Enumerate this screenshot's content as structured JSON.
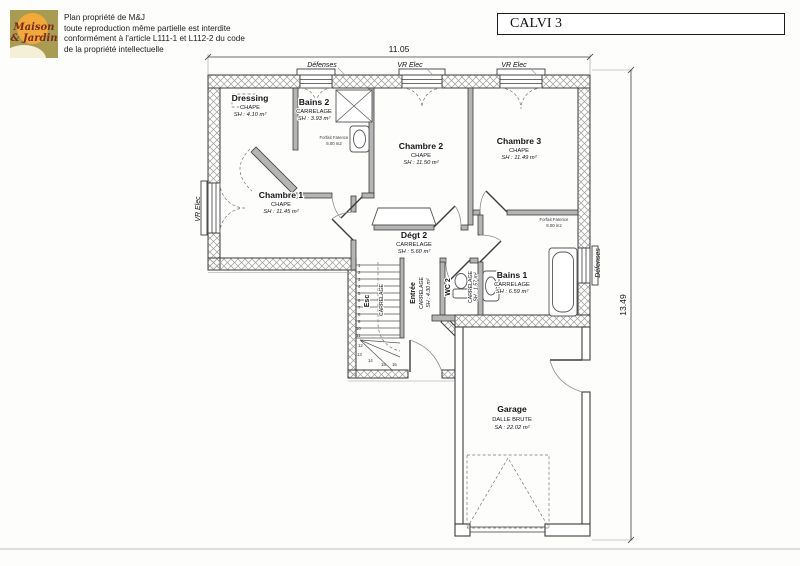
{
  "header": {
    "title": "CALVI 3",
    "logo": {
      "line1": "Maison",
      "line2": "& Jardin"
    },
    "copyright": {
      "line1": "Plan propriété de M&J",
      "line2": "toute reproduction même partielle est interdite",
      "line3": "conformément à l'article L111-1 et L112-2 du code",
      "line4": "de la propriété intellectuelle"
    }
  },
  "dimensions": {
    "top": "11.05",
    "right": "13.49"
  },
  "annotations": {
    "top_left": "Défenses",
    "top_mid": "VR Elec",
    "top_right": "VR Elec",
    "left": "VR Elec",
    "right": "Défenses",
    "faience_line1": "Forfait Faïence",
    "faience_line2": "8.00 m2"
  },
  "rooms": {
    "dressing": {
      "name": "Dressing",
      "finish": "CHAPE",
      "area": "SH : 4.10 m²"
    },
    "bains2": {
      "name": "Bains 2",
      "finish": "CARRELAGE",
      "area": "SH : 3.93 m²"
    },
    "chambre2": {
      "name": "Chambre 2",
      "finish": "CHAPE",
      "area": "SH : 11.50 m²"
    },
    "chambre3": {
      "name": "Chambre 3",
      "finish": "CHAPE",
      "area": "SH : 11.49 m²"
    },
    "chambre1": {
      "name": "Chambre 1",
      "finish": "CHAPE",
      "area": "SH : 11.45 m²"
    },
    "degt2": {
      "name": "Dégt 2",
      "finish": "CARRELAGE",
      "area": "SH : 5.60 m²"
    },
    "entree": {
      "name": "Entrée",
      "finish": "CARRELAGE",
      "area": "SH : 4.30 m²"
    },
    "wc2": {
      "name": "WC 2",
      "finish": "CARRELAGE",
      "area": "SH : 1.57 m²"
    },
    "bains1": {
      "name": "Bains 1",
      "finish": "CARRELAGE",
      "area": "SH : 6.59 m²"
    },
    "esc": {
      "name": "Esc",
      "finish": "CARRELAGE"
    },
    "garage": {
      "name": "Garage",
      "finish": "DALLE BRUTE",
      "area": "SA : 22.02 m²"
    }
  },
  "stairs": {
    "numbers": [
      "1",
      "2",
      "3",
      "4",
      "5",
      "6",
      "7",
      "8",
      "9",
      "10",
      "11",
      "12",
      "13",
      "14",
      "15",
      "16"
    ]
  },
  "colors": {
    "logo_bg": "#a79c52",
    "logo_sun": "#f2a93b",
    "logo_text": "#7a2a18",
    "line": "#3c3c3c"
  }
}
